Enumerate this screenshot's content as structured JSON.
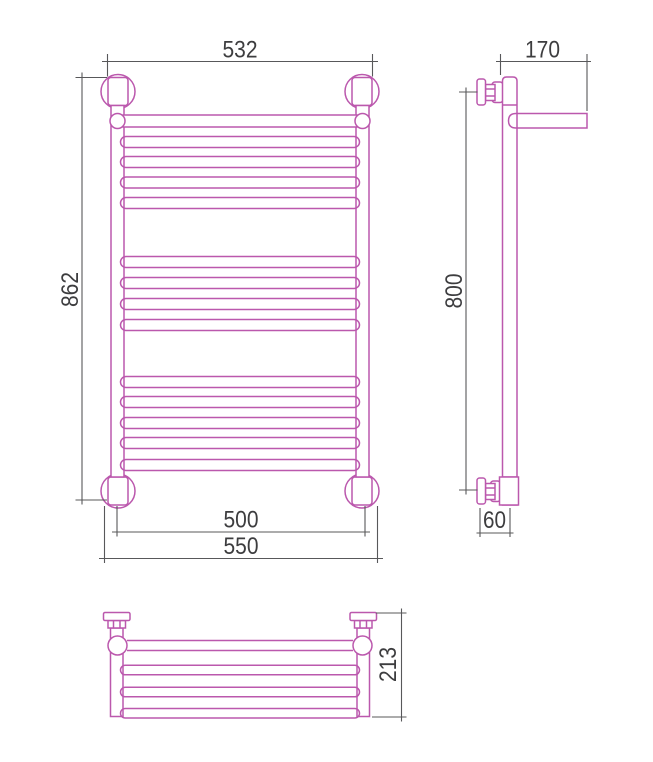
{
  "drawing": {
    "description": "ladder towel rail technical drawing, three views",
    "colors": {
      "product_outline": "#bb58ad",
      "dimension_lines": "#58585a",
      "dimension_text": "#3d3d3f",
      "background": "#ffffff"
    },
    "views": {
      "front": {
        "dimensions": {
          "top_width": "532",
          "overall_height": "862",
          "bottom_pipe_span": "500",
          "bottom_overall_width": "550"
        },
        "rung_groups": [
          4,
          4,
          5
        ]
      },
      "side": {
        "dimensions": {
          "shelf_depth": "170",
          "bracket_spacing_height": "800",
          "wall_offset": "60"
        }
      },
      "top": {
        "dimensions": {
          "overall_depth": "213"
        },
        "shelf_bar_count": 4
      }
    }
  }
}
